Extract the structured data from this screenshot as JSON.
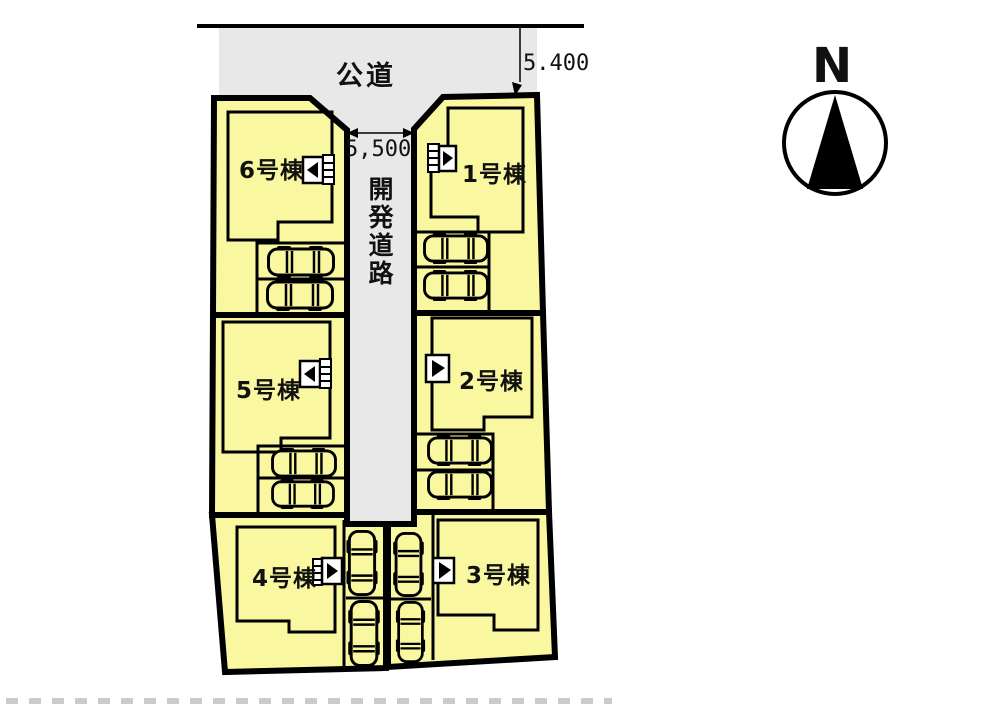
{
  "compass": {
    "north_label": "N"
  },
  "public_road": {
    "label": "公道",
    "width_dim": "5.400"
  },
  "dev_road": {
    "label": "開発道路",
    "width_dim": "5,500"
  },
  "lots": [
    {
      "label": "1号棟"
    },
    {
      "label": "2号棟"
    },
    {
      "label": "3号棟"
    },
    {
      "label": "4号棟"
    },
    {
      "label": "5号棟"
    },
    {
      "label": "6号棟"
    }
  ],
  "colors": {
    "lot_fill": "#f9f8a0",
    "road_fill": "#e8e8e8",
    "outline": "#000000",
    "background": "#ffffff"
  }
}
